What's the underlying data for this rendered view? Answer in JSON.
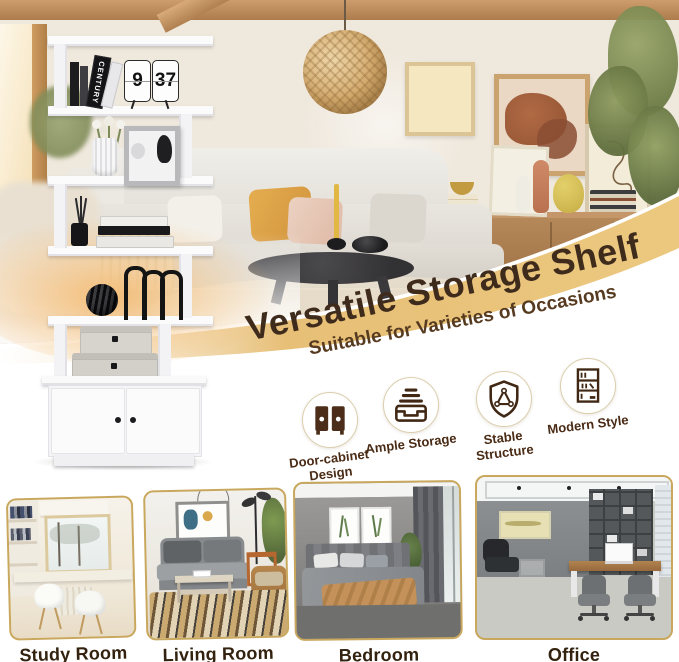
{
  "palette": {
    "band_gold": "#e7bf77",
    "title_brown": "#3e2b1c",
    "subtitle_brown": "#573b20",
    "feature_label_brown": "#4a2b15",
    "room_label_brown": "#33220f",
    "photo_border_gold": "#c9a85e",
    "glow_peach": "#f3b86c"
  },
  "hero": {
    "title": "Versatile Storage Shelf",
    "subtitle": "Suitable for Varieties of Occasions"
  },
  "shelf_decor": {
    "book_spine": "CENTURY",
    "clock_hour": "9",
    "clock_minute": "37"
  },
  "features": [
    {
      "icon": "door-cabinet-icon",
      "label": "Door-cabinet Design"
    },
    {
      "icon": "storage-tray-icon",
      "label": "Ample Storage"
    },
    {
      "icon": "shield-triangle-icon",
      "label": "Stable Structure"
    },
    {
      "icon": "modern-shelf-icon",
      "label": "Modern Style"
    }
  ],
  "rooms": [
    {
      "label": "Study Room"
    },
    {
      "label": "Living Room"
    },
    {
      "label": "Bedroom"
    },
    {
      "label": "Office"
    }
  ]
}
